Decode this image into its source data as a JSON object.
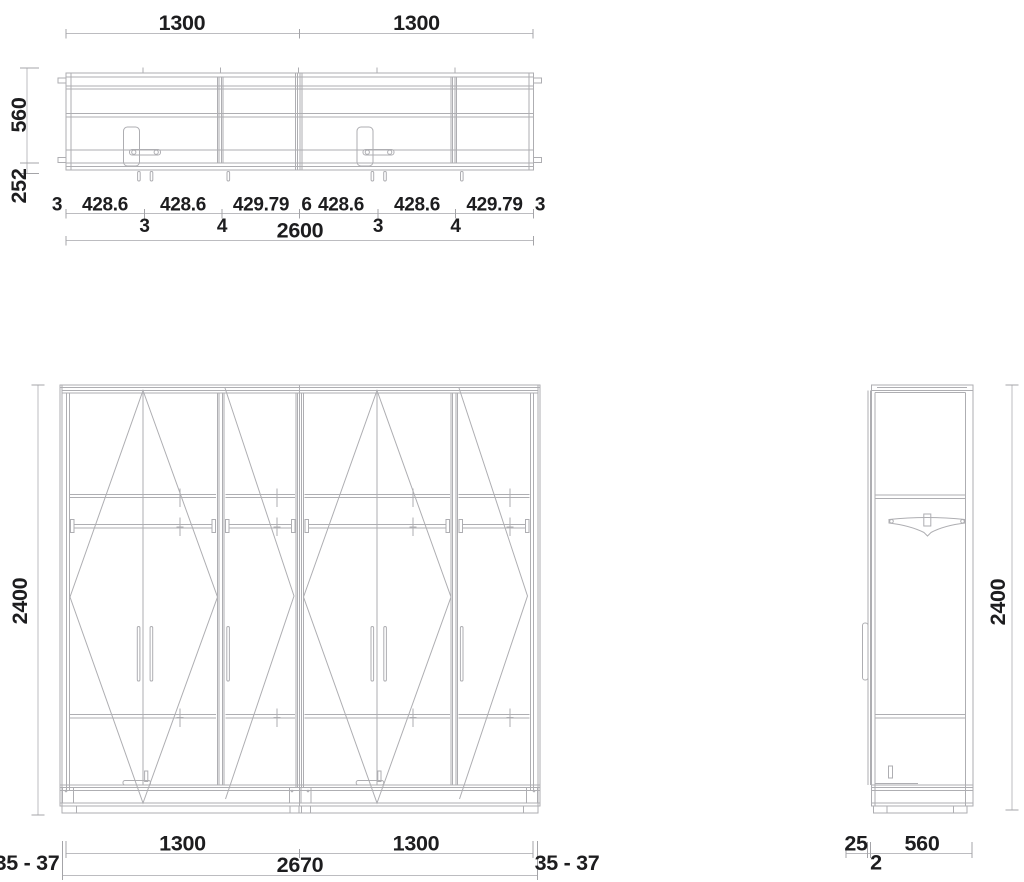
{
  "document": {
    "type": "furniture technical drawing - wardrobe",
    "background": "#ffffff"
  },
  "colors": {
    "drawing_line": "#aeaeb2",
    "dimension_line": "#bcbcc0",
    "text": "#1d1d1f"
  },
  "plan_view": {
    "top_widths": [
      "1300",
      "1300"
    ],
    "depth": "560",
    "front_zone": "252",
    "chain": [
      "3",
      "428.6",
      "3",
      "428.6",
      "4",
      "429.79",
      "6",
      "428.6",
      "3",
      "428.6",
      "4",
      "429.79",
      "3"
    ],
    "overall_width": "2600"
  },
  "front_view": {
    "height": "2400",
    "module_widths": [
      "1300",
      "1300"
    ],
    "overall_width": "2670",
    "side_gaps": [
      "35 - 37",
      "35 - 37"
    ]
  },
  "side_view": {
    "height": "2400",
    "handle_offset": "25",
    "gap": "2",
    "depth": "560"
  }
}
